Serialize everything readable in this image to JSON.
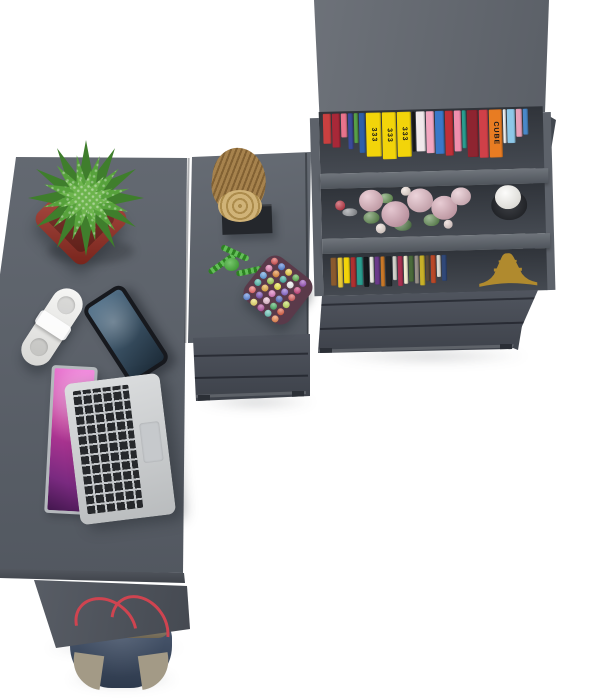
{
  "scene": {
    "description": "Top-down 3D product render of a dark grey L-shaped corner desk with drawer pedestals and a bookcase, styled with accessories on a white floor",
    "background": "#ffffff"
  },
  "palette": {
    "desk_surface": "#585e67",
    "desk_edge": "#474c55",
    "leg_panel": "#4e535c",
    "pedestal_front": "#474c56",
    "bookcase_top": "#61666e",
    "bookcase_side": "#42474f",
    "shelf_face": "#585e66",
    "shelf_cavity": "#3d424a",
    "drawer_front": "#474c56",
    "pot_red": "#a93226",
    "cactus_dark": "#3f7e2c",
    "cactus_mid": "#57a23c",
    "cactus_light": "#6cb44c",
    "log_wood": "#a07a42",
    "log_face": "#c8a660",
    "stand_black": "#24272c",
    "rope_green": "#3cae2e",
    "pouch_base": "#5a3a4a",
    "laptop_silver": "#c9ccce",
    "phone_body": "#17191e",
    "phone_screen": "#2c4357",
    "remote_white": "#efefec",
    "bag_denim": "#3d4d66",
    "bag_trim": "#8d8168",
    "bag_strap_red": "#cf4450",
    "candle_wax": "#f3f1ea",
    "candle_glass": "#25282e",
    "eiffel_gold": "#b08a2e",
    "rose_pink": "#d5a4b2"
  },
  "books_top": [
    {
      "c": "#c94040",
      "w": 8,
      "h": 30
    },
    {
      "c": "#a82838",
      "w": 8,
      "h": 34
    },
    {
      "c": "#e8738c",
      "w": 6,
      "h": 24
    },
    {
      "c": "#3a4a9a",
      "w": 5,
      "h": 36
    },
    {
      "c": "#58a048",
      "w": 4,
      "h": 30
    },
    {
      "c": "#2f5fa8",
      "w": 6,
      "h": 40
    },
    {
      "c": "#f2d40a",
      "w": 15,
      "h": 44,
      "label": "333"
    },
    {
      "c": "#f2d40a",
      "w": 14,
      "h": 47,
      "label": "333"
    },
    {
      "c": "#f2d40a",
      "w": 14,
      "h": 45,
      "label": "333"
    },
    {
      "c": "#1a1a1a",
      "w": 3,
      "h": 40
    },
    {
      "c": "#f0e8ea",
      "w": 9,
      "h": 40
    },
    {
      "c": "#f2a7c0",
      "w": 8,
      "h": 42
    },
    {
      "c": "#3a78c8",
      "w": 9,
      "h": 43
    },
    {
      "c": "#c03038",
      "w": 8,
      "h": 45
    },
    {
      "c": "#ef8fae",
      "w": 7,
      "h": 41
    },
    {
      "c": "#2a9d8f",
      "w": 4,
      "h": 38
    },
    {
      "c": "#8e2430",
      "w": 11,
      "h": 47
    },
    {
      "c": "#d04048",
      "w": 9,
      "h": 48
    },
    {
      "c": "#e87c22",
      "w": 13,
      "h": 48,
      "label": "CUBE"
    },
    {
      "c": "#f0f0f0",
      "w": 3,
      "h": 34
    },
    {
      "c": "#8ec8e8",
      "w": 8,
      "h": 34
    },
    {
      "c": "#e8a0b8",
      "w": 6,
      "h": 28
    },
    {
      "c": "#4a88c8",
      "w": 5,
      "h": 26
    }
  ],
  "books_small": [
    {
      "c": "#8a5a2e",
      "w": 6,
      "h": 28
    },
    {
      "c": "#e8c838",
      "w": 5,
      "h": 30
    },
    {
      "c": "#f2d40a",
      "w": 6,
      "h": 26
    },
    {
      "c": "#b03030",
      "w": 5,
      "h": 30
    },
    {
      "c": "#2a9d8f",
      "w": 6,
      "h": 28
    },
    {
      "c": "#14181c",
      "w": 5,
      "h": 30
    },
    {
      "c": "#e8e8e0",
      "w": 4,
      "h": 26
    },
    {
      "c": "#6a3a8a",
      "w": 5,
      "h": 28
    },
    {
      "c": "#c87828",
      "w": 4,
      "h": 30
    },
    {
      "c": "#22262a",
      "w": 6,
      "h": 30
    },
    {
      "c": "#d0d0c8",
      "w": 4,
      "h": 24
    },
    {
      "c": "#a83050",
      "w": 5,
      "h": 30
    },
    {
      "c": "#f0ead0",
      "w": 4,
      "h": 28
    },
    {
      "c": "#4a6a3a",
      "w": 5,
      "h": 26
    },
    {
      "c": "#989088",
      "w": 4,
      "h": 28
    },
    {
      "c": "#c8b028",
      "w": 5,
      "h": 30
    },
    {
      "c": "#584838",
      "w": 4,
      "h": 26
    },
    {
      "c": "#b84828",
      "w": 5,
      "h": 28
    },
    {
      "c": "#d8d8d0",
      "w": 4,
      "h": 22
    },
    {
      "c": "#304878",
      "w": 5,
      "h": 26
    }
  ],
  "flowers": [
    {
      "x": 0,
      "y": 12,
      "w": 10,
      "h": 10,
      "c": "#b82030"
    },
    {
      "x": 7,
      "y": 20,
      "w": 15,
      "h": 8,
      "c": "#888b90"
    },
    {
      "x": 28,
      "y": 24,
      "w": 16,
      "h": 12,
      "c": "#4e7c3c"
    },
    {
      "x": 58,
      "y": 32,
      "w": 18,
      "h": 12,
      "c": "#45703a"
    },
    {
      "x": 88,
      "y": 28,
      "w": 16,
      "h": 12,
      "c": "#507e40"
    },
    {
      "x": 44,
      "y": 6,
      "w": 14,
      "h": 10,
      "c": "#5a8a46"
    },
    {
      "x": 24,
      "y": 2,
      "w": 24,
      "h": 22,
      "c": "#d9a8b5"
    },
    {
      "x": 46,
      "y": 14,
      "w": 28,
      "h": 26,
      "c": "#cf9aab"
    },
    {
      "x": 72,
      "y": 2,
      "w": 26,
      "h": 24,
      "c": "#dcb0bc"
    },
    {
      "x": 96,
      "y": 10,
      "w": 26,
      "h": 24,
      "c": "#d4a2b0"
    },
    {
      "x": 116,
      "y": 2,
      "w": 20,
      "h": 18,
      "c": "#e0b8c2"
    },
    {
      "x": 40,
      "y": 36,
      "w": 10,
      "h": 10,
      "c": "#e9d9d2"
    },
    {
      "x": 66,
      "y": 0,
      "w": 10,
      "h": 9,
      "c": "#ecdcd4"
    },
    {
      "x": 108,
      "y": 34,
      "w": 9,
      "h": 9,
      "c": "#e5d0cc"
    }
  ],
  "pompoms": [
    "#d23b3b",
    "#3b6fd2",
    "#e8c52a",
    "#46a636",
    "#8a3ab0",
    "#e06fa8",
    "#e07820",
    "#2aa396",
    "#f0f0f0",
    "#c02a6a",
    "#4a90d8",
    "#90c838",
    "#e8e02a",
    "#7a52c8",
    "#d24848",
    "#38b0a0",
    "#e0a028",
    "#d868b8",
    "#3a58b8",
    "#b8d848",
    "#e85858",
    "#6838a8",
    "#e8b8d0",
    "#30a050",
    "#d84828",
    "#4878d8",
    "#e8d858",
    "#a83890",
    "#58c0b0",
    "#e87838"
  ]
}
